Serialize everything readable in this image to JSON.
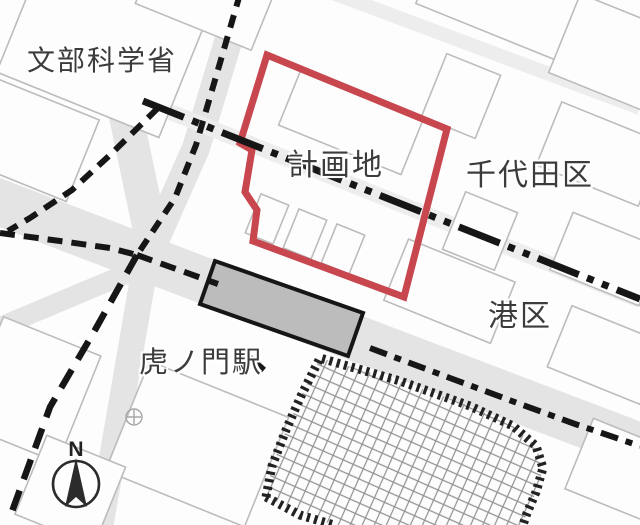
{
  "map": {
    "labels": {
      "ministry": "文部科学省",
      "planning_site": "計画地",
      "chiyoda_ward": "千代田区",
      "minato_ward": "港区",
      "toranomon_station": "虎ノ門駅",
      "compass_north": "N"
    },
    "colors": {
      "planning_site_outline": "#c8464e",
      "boundary_line": "#161616",
      "station_box_fill": "#9b9b9b",
      "label_text": "#3c3c3c",
      "base_building_line": "#bcbcbc",
      "road_fill": "#e4e4e4",
      "hatch_line": "#919191"
    }
  }
}
